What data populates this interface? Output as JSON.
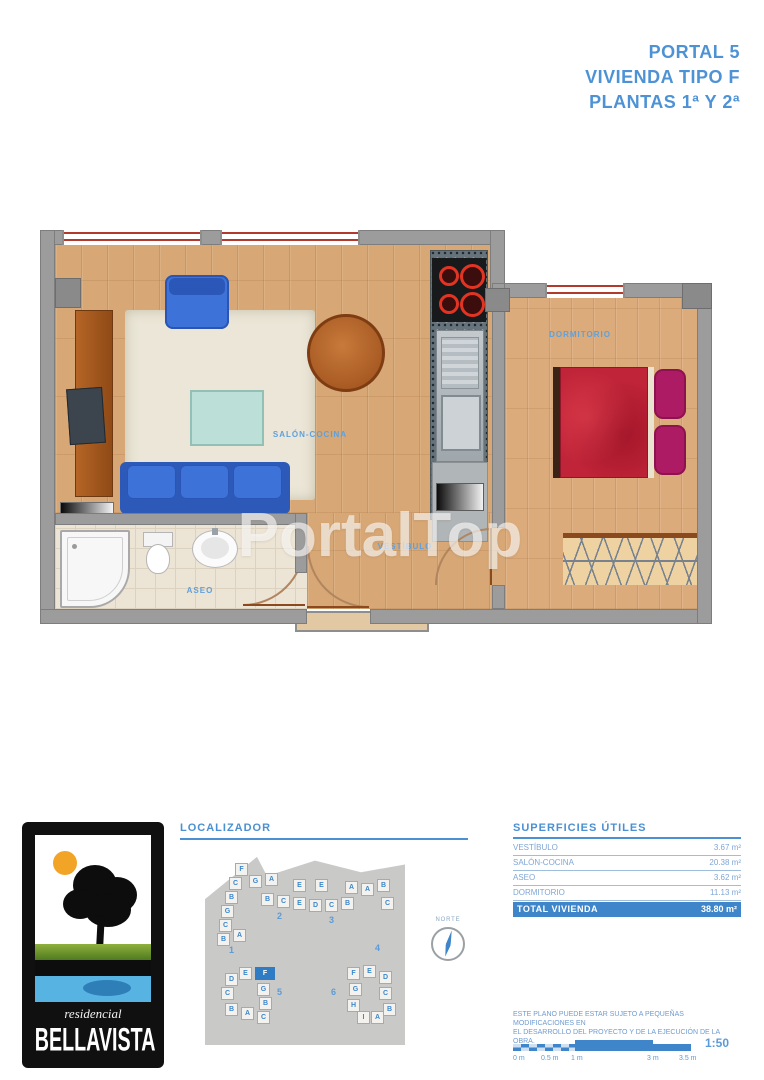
{
  "title": {
    "lines": [
      "PORTAL 5",
      "VIVIENDA TIPO F",
      "PLANTAS 1ª Y 2ª"
    ]
  },
  "watermark": "PortalTop",
  "plan_labels": {
    "salon": "SALÓN-COCINA",
    "dormitorio": "DORMITORIO",
    "aseo": "ASEO",
    "vestibulo": "VESTÍBULO"
  },
  "logo": {
    "residencial": "residencial",
    "bellavista": "BELLAVISTA"
  },
  "localizador": {
    "heading": "LOCALIZADOR",
    "norte": "NORTE",
    "highlight_unit": "F",
    "buildings": [
      {
        "t": "F",
        "x": 30,
        "y": 10
      },
      {
        "t": "C",
        "x": 24,
        "y": 24
      },
      {
        "t": "G",
        "x": 44,
        "y": 22
      },
      {
        "t": "A",
        "x": 60,
        "y": 20
      },
      {
        "t": "B",
        "x": 20,
        "y": 38
      },
      {
        "t": "B",
        "x": 56,
        "y": 40
      },
      {
        "t": "C",
        "x": 72,
        "y": 42
      },
      {
        "t": "E",
        "x": 88,
        "y": 26
      },
      {
        "t": "E",
        "x": 110,
        "y": 26
      },
      {
        "t": "E",
        "x": 88,
        "y": 44
      },
      {
        "t": "D",
        "x": 104,
        "y": 46
      },
      {
        "t": "C",
        "x": 120,
        "y": 46
      },
      {
        "t": "B",
        "x": 136,
        "y": 44
      },
      {
        "t": "A",
        "x": 140,
        "y": 28
      },
      {
        "t": "A",
        "x": 156,
        "y": 30
      },
      {
        "t": "B",
        "x": 172,
        "y": 26
      },
      {
        "t": "C",
        "x": 176,
        "y": 44
      },
      {
        "t": "G",
        "x": 16,
        "y": 52
      },
      {
        "t": "C",
        "x": 14,
        "y": 66
      },
      {
        "t": "B",
        "x": 12,
        "y": 80
      },
      {
        "t": "A",
        "x": 28,
        "y": 76
      },
      {
        "t": "D",
        "x": 20,
        "y": 120
      },
      {
        "t": "E",
        "x": 34,
        "y": 114
      },
      {
        "t": "F",
        "x": 50,
        "y": 114,
        "h": true
      },
      {
        "t": "C",
        "x": 16,
        "y": 134
      },
      {
        "t": "G",
        "x": 52,
        "y": 130
      },
      {
        "t": "B",
        "x": 54,
        "y": 144
      },
      {
        "t": "B",
        "x": 20,
        "y": 150
      },
      {
        "t": "A",
        "x": 36,
        "y": 154
      },
      {
        "t": "C",
        "x": 52,
        "y": 158
      },
      {
        "t": "F",
        "x": 142,
        "y": 114
      },
      {
        "t": "E",
        "x": 158,
        "y": 112
      },
      {
        "t": "D",
        "x": 174,
        "y": 118
      },
      {
        "t": "G",
        "x": 144,
        "y": 130
      },
      {
        "t": "C",
        "x": 174,
        "y": 134
      },
      {
        "t": "H",
        "x": 142,
        "y": 146
      },
      {
        "t": "I",
        "x": 152,
        "y": 158
      },
      {
        "t": "A",
        "x": 166,
        "y": 158
      },
      {
        "t": "B",
        "x": 178,
        "y": 150
      }
    ],
    "numbers": [
      {
        "t": "1",
        "x": 24,
        "y": 92
      },
      {
        "t": "2",
        "x": 72,
        "y": 58
      },
      {
        "t": "3",
        "x": 124,
        "y": 62
      },
      {
        "t": "4",
        "x": 170,
        "y": 90
      },
      {
        "t": "5",
        "x": 72,
        "y": 134
      },
      {
        "t": "6",
        "x": 126,
        "y": 134
      }
    ]
  },
  "superficies": {
    "heading": "SUPERFICIES ÚTILES",
    "rows": [
      {
        "label": "VESTÍBULO",
        "value": "3.67 m²"
      },
      {
        "label": "SALÓN-COCINA",
        "value": "20.38 m²"
      },
      {
        "label": "ASEO",
        "value": "3.62 m²"
      },
      {
        "label": "DORMITORIO",
        "value": "11.13 m²"
      }
    ],
    "total": {
      "label": "TOTAL VIVIENDA",
      "value": "38.80 m²"
    }
  },
  "disclaimer_line1": "ESTE PLANO PUEDE ESTAR SUJETO A PEQUEÑAS MODIFICACIONES EN",
  "disclaimer_line2": "EL DESARROLLO DEL PROYECTO Y DE LA EJECUCIÓN DE LA OBRA.",
  "scale": {
    "ratio": "1:50",
    "ticks": [
      "0 m",
      "0.5 m",
      "1 m",
      "3 m",
      "3.5 m"
    ]
  },
  "colors": {
    "accent": "#4a90d2",
    "total_row_bg": "#3e86c9",
    "highlight_unit": "#2f7bc4"
  }
}
